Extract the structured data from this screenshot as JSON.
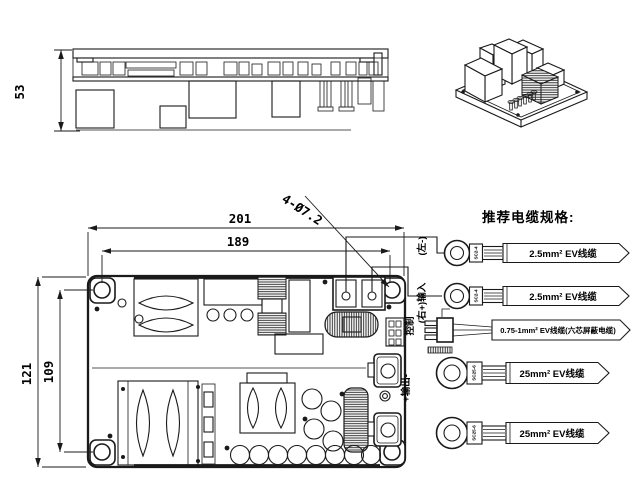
{
  "meta": {
    "background": "#ffffff",
    "ink": "#1a1a1a"
  },
  "dims": {
    "side_height": "53",
    "board_width": "201",
    "hole_pitch_x": "189",
    "board_height": "121",
    "hole_pitch_y": "109",
    "hole_callout": "4-Ø7.2"
  },
  "ports": {
    "input_neg": "(左-)",
    "input_pos": "(右+)输入",
    "control": "控制",
    "output": "+输出-"
  },
  "cable_spec": {
    "title": "推荐电缆规格:",
    "items": [
      {
        "lug_mark": "SC2-4",
        "label": "2.5mm² EV线缆"
      },
      {
        "lug_mark": "SC2-4",
        "label": "2.5mm² EV线缆"
      },
      {
        "lug_mark": "",
        "label": "0.75-1mm² EV线缆(六芯屏蔽电缆)"
      },
      {
        "lug_mark": "SC25-6",
        "label": "25mm² EV线缆"
      },
      {
        "lug_mark": "SC25-6",
        "label": "25mm² EV线缆"
      }
    ]
  }
}
